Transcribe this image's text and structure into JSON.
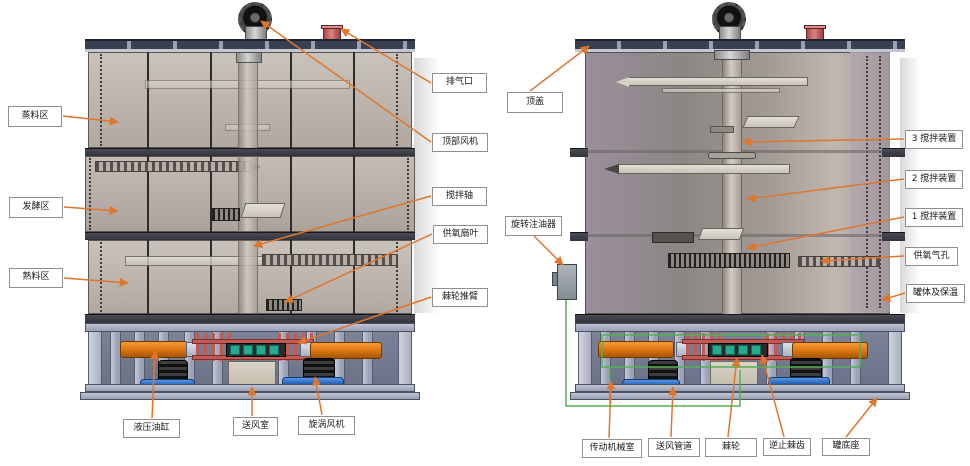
{
  "figure": {
    "description_labels_language": "zh",
    "colors": {
      "leader_arrow": "#e0752c",
      "exhaust_port_red": "#c96a66",
      "hydraulic_orange": "#e07b16",
      "pipe_blue": "#2e6fc4",
      "ratchet_teal": "#27a890",
      "wire_green": "#55b055",
      "lid_dark": "#3a4052",
      "tank_wall": "#bcb4ad"
    }
  },
  "labels": [
    {
      "id": "steam-zone",
      "text": "蒸料区"
    },
    {
      "id": "ferment-zone",
      "text": "发酵区"
    },
    {
      "id": "cooked-zone",
      "text": "熟料区"
    },
    {
      "id": "exhaust-port",
      "text": "排气口"
    },
    {
      "id": "top-fan",
      "text": "顶部风机"
    },
    {
      "id": "stir-shaft",
      "text": "搅拌轴"
    },
    {
      "id": "oxygen-fan-blade",
      "text": "供氧扇叶"
    },
    {
      "id": "ratchet-push-arm",
      "text": "棘轮推臂"
    },
    {
      "id": "hydraulic-cylinder",
      "text": "液压油缸"
    },
    {
      "id": "air-supply-chamber",
      "text": "送风室"
    },
    {
      "id": "vortex-fan",
      "text": "旋涡风机"
    },
    {
      "id": "top-cover",
      "text": "顶盖"
    },
    {
      "id": "rotary-oiler",
      "text": "旋转注油器"
    },
    {
      "id": "stir-device-3",
      "text": "3 搅拌装置"
    },
    {
      "id": "stir-device-2",
      "text": "2 搅拌装置"
    },
    {
      "id": "stir-device-1",
      "text": "1 搅拌装置"
    },
    {
      "id": "oxygen-holes",
      "text": "供氧气孔"
    },
    {
      "id": "tank-body-insulation",
      "text": "罐体及保温"
    },
    {
      "id": "transmission-room",
      "text": "传动机械室"
    },
    {
      "id": "air-duct",
      "text": "送风管道"
    },
    {
      "id": "ratchet",
      "text": "棘轮"
    },
    {
      "id": "non-return-pawl",
      "text": "逆止棘齿"
    },
    {
      "id": "tank-base",
      "text": "罐底座"
    }
  ]
}
